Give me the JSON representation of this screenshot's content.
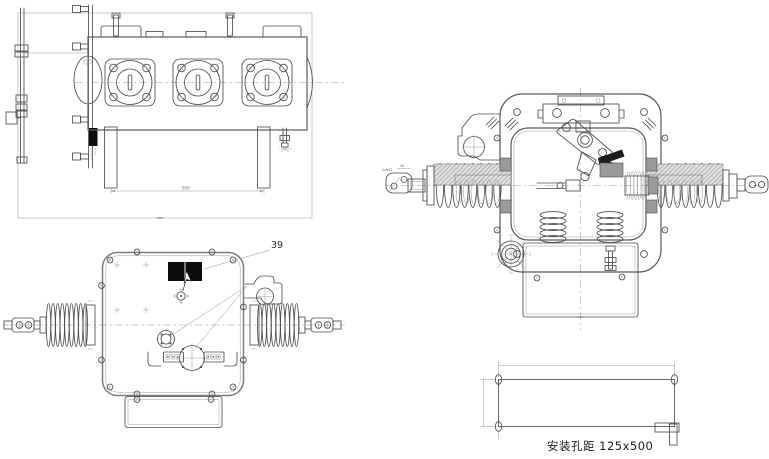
{
  "drawing_labels": {
    "front_view_part_number": "39",
    "mounting_note": "安装孔距 125x500",
    "top_view_dimension": "500",
    "terminal_dim_holes": "2xΦ12",
    "terminal_dim_width": "46"
  },
  "colors": {
    "background": "#ffffff",
    "main_line": "#4d4d4d",
    "thin_line": "#979797",
    "nameplate_fill": "#0d0d0d",
    "hatch_fill": "#8f8f8f"
  },
  "views": {
    "top_plan": "top plan view of three-pole breaker tank",
    "front": "front elevation with side bushings",
    "section": "cross-section through pole and mechanism",
    "mounting": "mounting hole layout"
  }
}
